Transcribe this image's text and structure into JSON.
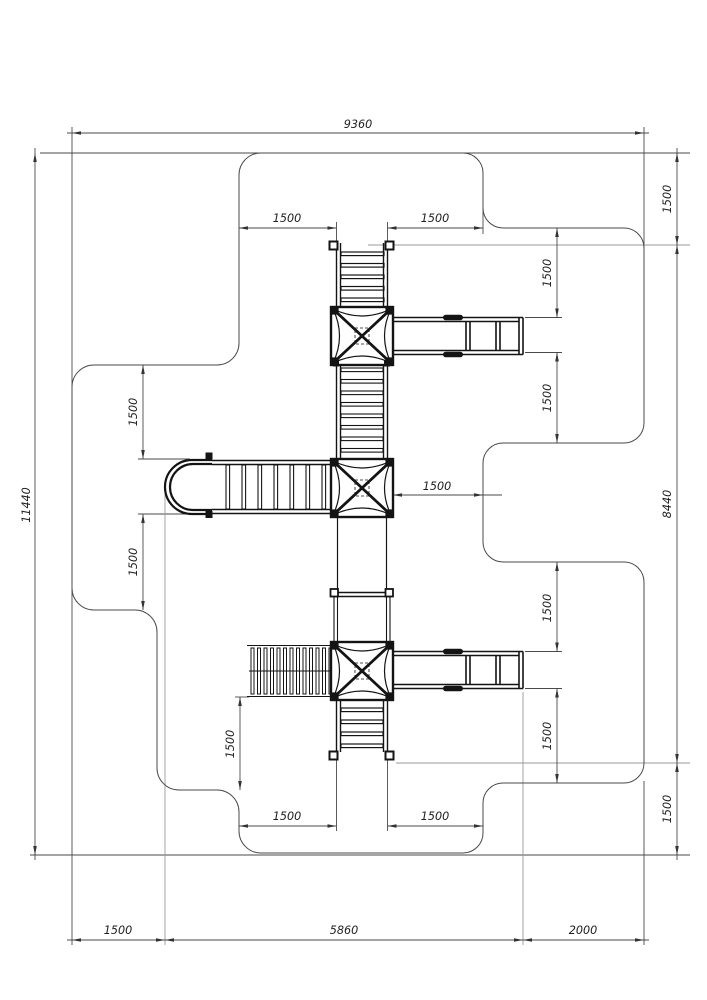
{
  "drawing": {
    "type": "playground-equipment-plan",
    "background": "#ffffff"
  },
  "colors": {
    "equipment": "#141414",
    "dimension_lines": "#4a4a4a",
    "extension_light": "#9a9a9a",
    "text": "#1f1f1f"
  },
  "dims": {
    "overall_width": "9360",
    "overall_height": "11440",
    "equipment_height": "8440",
    "top_clearance_right": "1500",
    "bottom_clearance_right": "1500",
    "bottom_left_offset": "1500",
    "bottom_equipment_width": "5860",
    "bottom_right_offset": "2000",
    "top_ladder_left_clearance": "1500",
    "top_ladder_right_clearance": "1500",
    "left_bridge_top_clearance": "1500",
    "left_bridge_bottom_clearance": "1500",
    "middle_tower_right_clearance": "1500",
    "upper_slide_top_clearance": "1500",
    "upper_slide_bottom_clearance": "1500",
    "lower_slide_top_clearance": "1500",
    "lower_slide_bottom_clearance": "1500",
    "climber_bottom_clearance": "1500",
    "bottom_ladder_left_clearance": "1500",
    "bottom_ladder_right_clearance": "1500"
  }
}
